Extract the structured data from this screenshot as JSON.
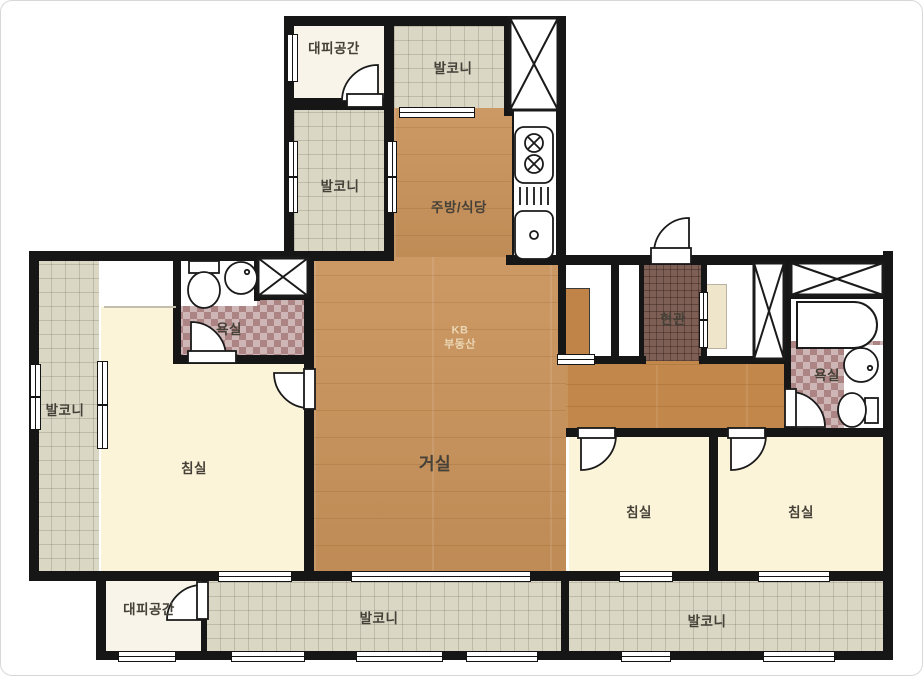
{
  "watermark": {
    "brand": "KB",
    "line2": "부동산"
  },
  "rooms": {
    "evac_top": "대피공간",
    "balcony_top": "발코니",
    "balcony_upper_left": "발코니",
    "kitchen": "주방/식당",
    "bath_left": "욕실",
    "balcony_left": "발코니",
    "bedroom_left": "침실",
    "living": "거실",
    "entrance": "현관",
    "bath_right": "욕실",
    "bedroom_mid": "침실",
    "bedroom_right": "침실",
    "evac_bottom": "대피공간",
    "balcony_bottom_left": "발코니",
    "balcony_bottom_right": "발코니"
  },
  "colors": {
    "wall": "#161616",
    "wood_floor": "#c9925a",
    "balcony_tile": "#dad7c4",
    "bath_tile": "#ad8484",
    "entrance_tile": "#7d5f55",
    "bedroom_floor": "#fbf4d8",
    "label_text": "#454038",
    "watermark_text": "#ecd9b9"
  }
}
